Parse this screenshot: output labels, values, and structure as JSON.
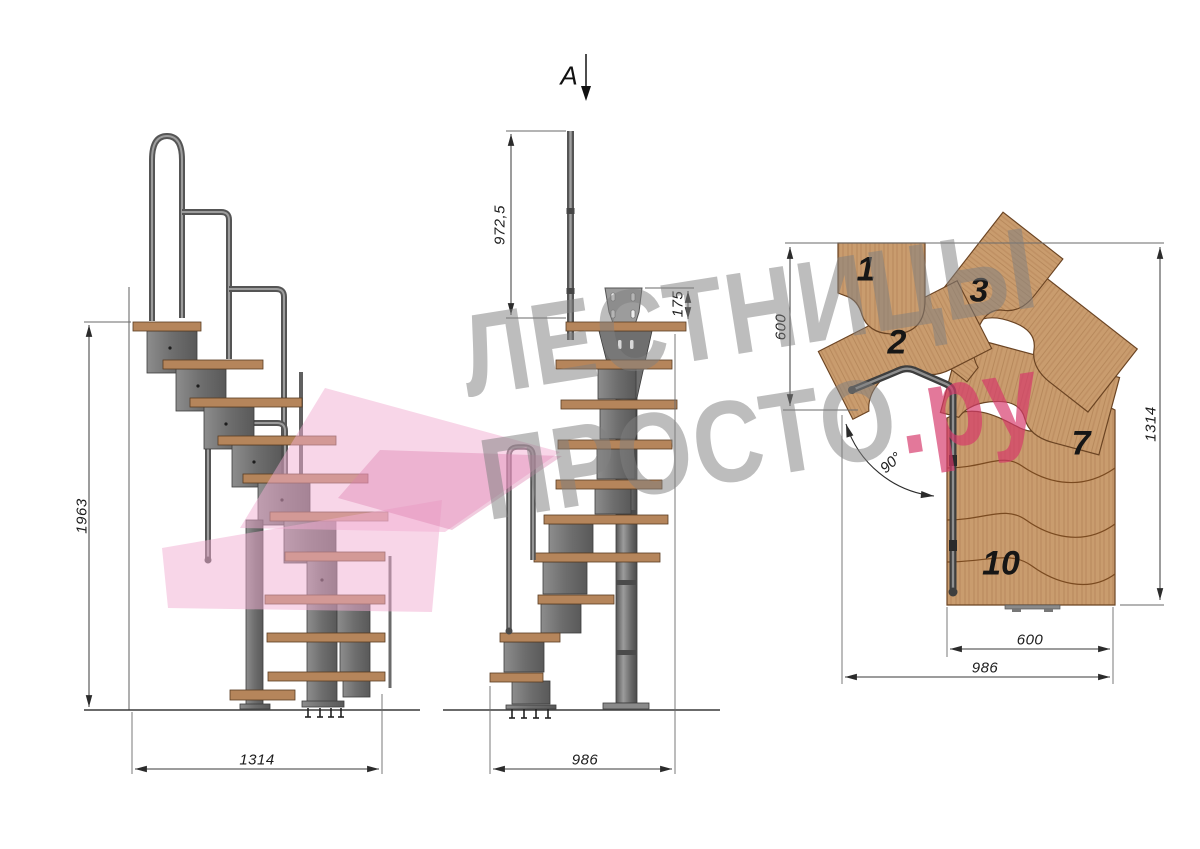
{
  "watermark": {
    "line1": "ЛЕСТНИЦЫ",
    "line2_gray": "ПРОСТО",
    "line2_pink": ".ру"
  },
  "section": {
    "label": "A"
  },
  "dimensions": {
    "side_view": {
      "total_height": "1963",
      "total_length": "1314"
    },
    "front_view": {
      "railing_height": "972,5",
      "mount_plate_offset": "175",
      "total_width": "986"
    },
    "plan_view": {
      "landing_depth": "600",
      "total_length": "1314",
      "step_width": "600",
      "total_width": "986",
      "turn_angle": "90°"
    }
  },
  "plan_step_numbers": [
    "1",
    "2",
    "3",
    "7",
    "10"
  ],
  "colors": {
    "wood_plan": "#c99c6e",
    "wood_tread": "#b5855b",
    "metal": "#7a7a7a",
    "dimension_lines": "#3a3a3a",
    "watermark_gray": "#9a9a9a",
    "accent_pink": "#d6386a",
    "logo_pink": "#f2aed2"
  }
}
